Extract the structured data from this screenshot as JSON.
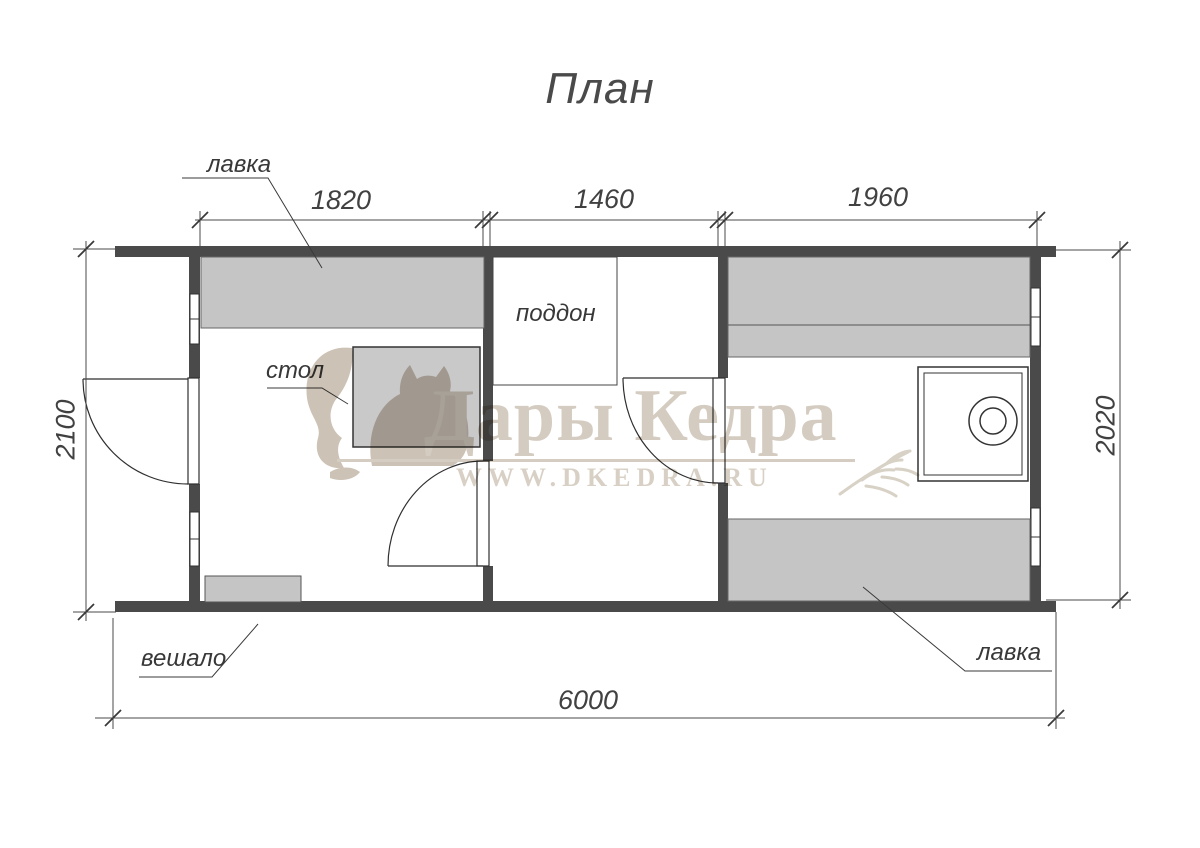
{
  "title": "План",
  "furniture": {
    "bench_top_label": "лавка",
    "table_label": "стол",
    "tray_label": "поддон",
    "hanger_label": "вешало",
    "bench_bottom_label": "лавка"
  },
  "dimensions": {
    "room1_width": "1820",
    "room2_width": "1460",
    "room3_width": "1960",
    "left_height": "2100",
    "right_height": "2020",
    "total_width": "6000"
  },
  "watermark": {
    "brand": "Дары Кедра",
    "url": "WWW.DKEDRA.RU"
  },
  "colors": {
    "wall": "#4a4a4a",
    "furniture_fill": "#c5c5c5",
    "line": "#3a3a3a",
    "watermark_beige": "#d5ccc1"
  }
}
